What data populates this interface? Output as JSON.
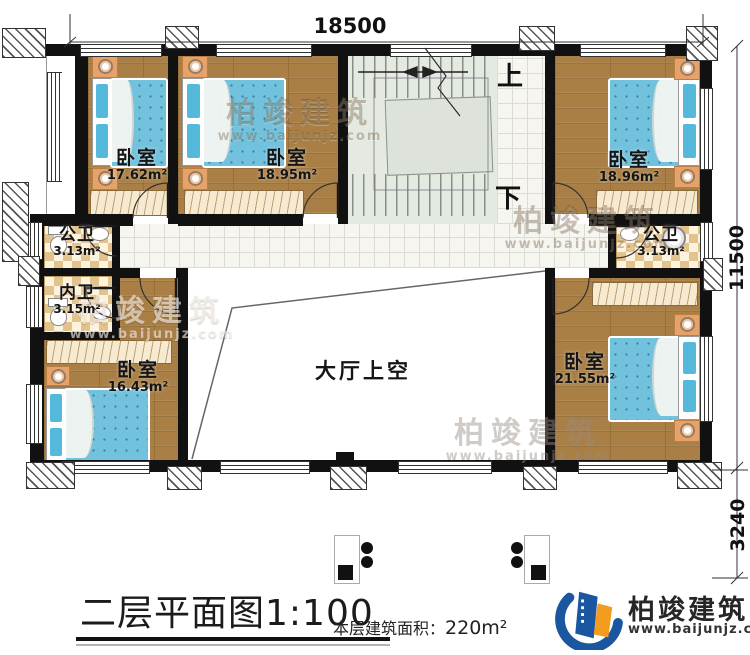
{
  "dimensions": {
    "width_top": "18500",
    "height_right": "11500",
    "porch_right": "3240"
  },
  "stairs": {
    "up_label": "上",
    "down_label": "下"
  },
  "rooms": {
    "bedroom_top_left": {
      "name": "卧室",
      "area": "17.62m²"
    },
    "bedroom_top_mid": {
      "name": "卧室",
      "area": "18.95m²"
    },
    "bedroom_top_right": {
      "name": "卧室",
      "area": "18.96m²"
    },
    "public_bath_left": {
      "name": "公卫",
      "area": "3.13m²"
    },
    "private_bath_left": {
      "name": "内卫",
      "area": "3.15m²"
    },
    "bedroom_bottom_left": {
      "name": "卧室",
      "area": "16.43m²"
    },
    "public_bath_right": {
      "name": "公卫",
      "area": "3.13m²"
    },
    "bedroom_bottom_right": {
      "name": "卧室",
      "area": "21.55m²"
    },
    "hall_void": {
      "name": "大厅上空"
    }
  },
  "title_block": {
    "title": "二层平面图1:100",
    "area_label": "本层建筑面积：",
    "area_value": "220m²"
  },
  "brand": {
    "name": "柏竣建筑",
    "url": "www.baijunjz.com"
  },
  "watermark": {
    "name": "柏竣建筑",
    "url": "www.baijunjz.com"
  },
  "colors": {
    "brand_blue": "#1a57a0",
    "brand_orange": "#f39c1f",
    "wall": "#111111",
    "wood_floor": "#a97f45",
    "mattress_blue": "#72c2de"
  }
}
